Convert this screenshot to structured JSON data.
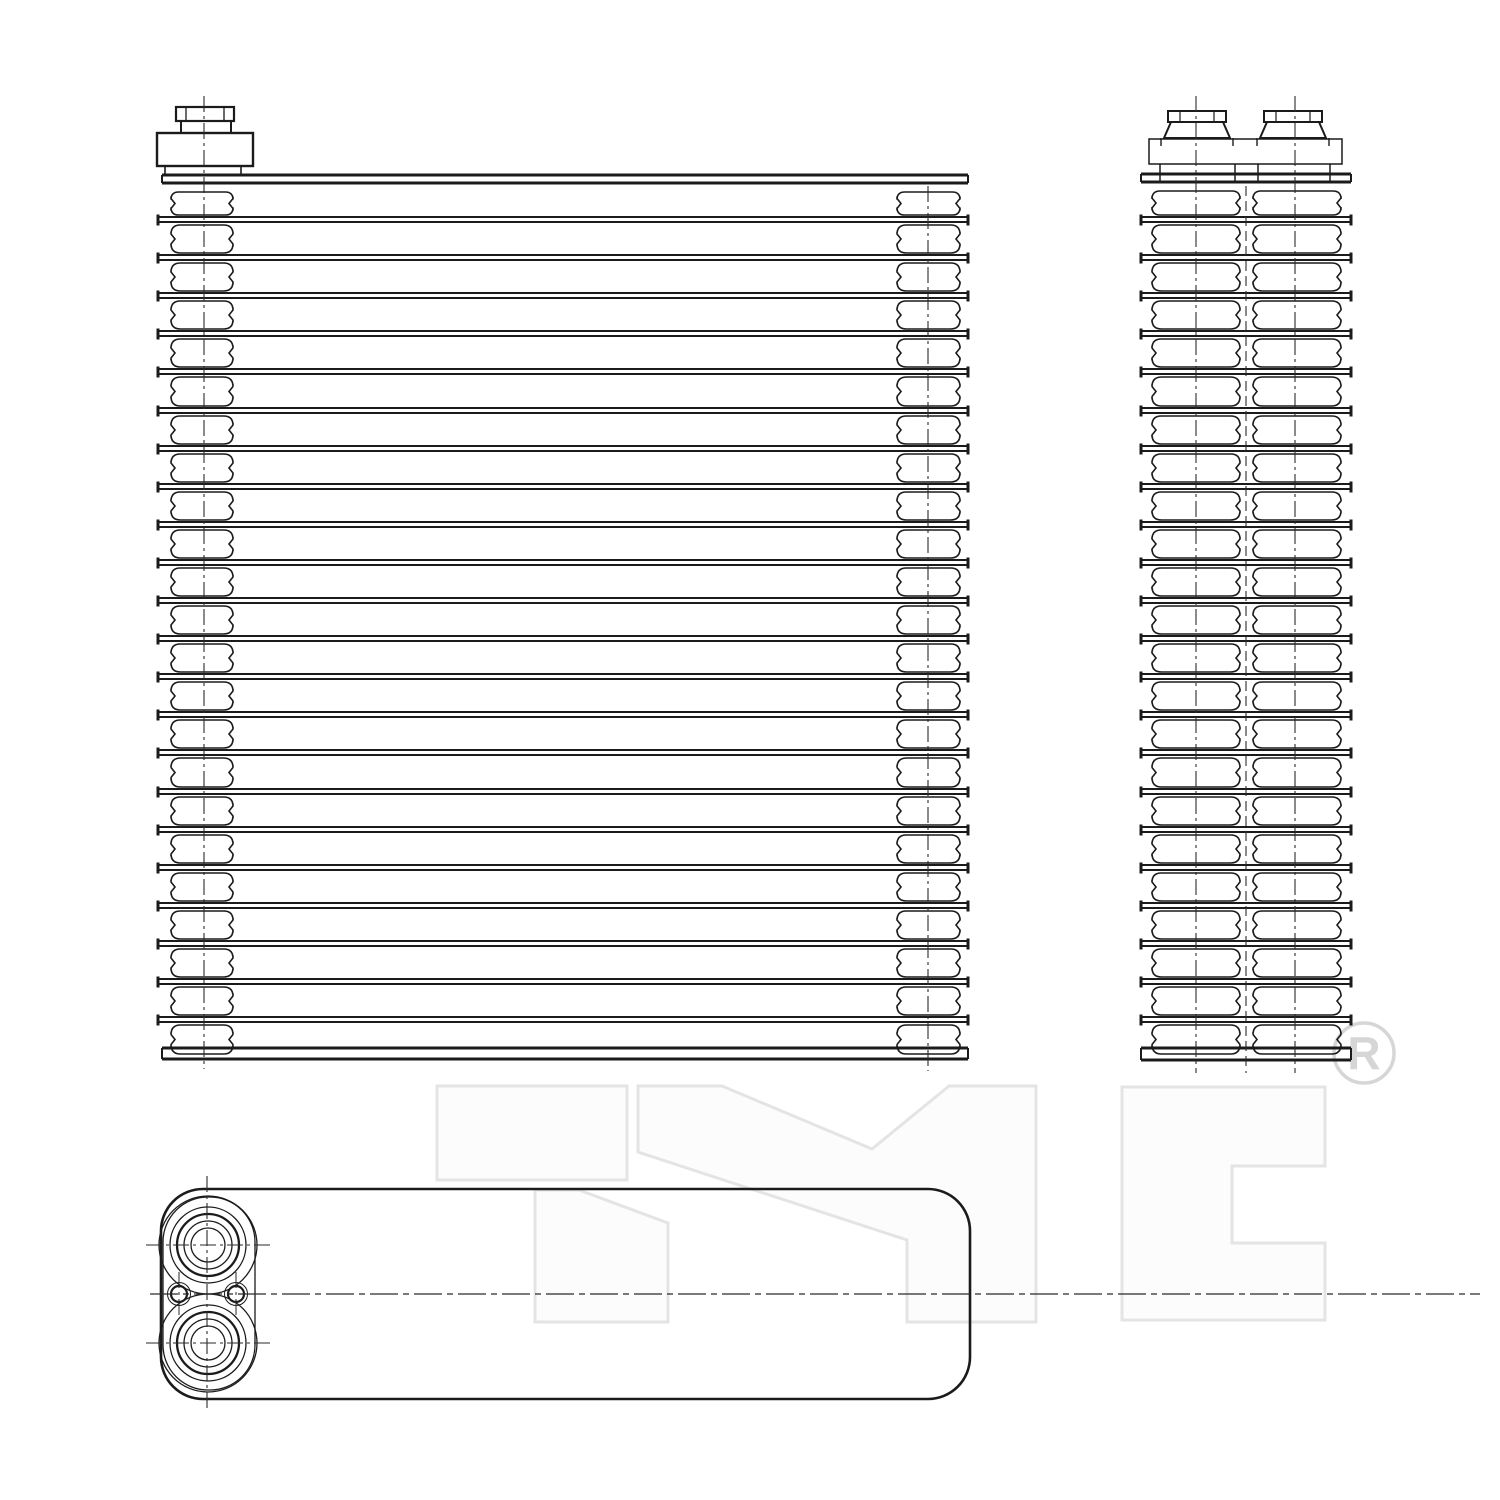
{
  "page": {
    "background": "#ffffff",
    "line_color": "#1b1b1b",
    "thin_line_color": "#2a2a2a",
    "watermark_outline_color": "#e4e4e4",
    "watermark_fill_color": "#fcfcfc",
    "registered_mark_color": "#d6d6d6"
  },
  "watermark": {
    "text": "TYC",
    "registered_symbol": "®",
    "registered_letter": "R",
    "reg_cx": 1364,
    "reg_cy": 1053,
    "reg_r": 30
  },
  "fins": {
    "count": 22,
    "first_y": 217,
    "spacing": 38.1,
    "band_gap": 5
  },
  "front_view": {
    "fin_x1": 158,
    "fin_x2": 968,
    "top_plate": {
      "x1": 162,
      "x2": 968,
      "y1": 175,
      "y2": 183
    },
    "bottom_plate": {
      "x1": 162,
      "x2": 968,
      "y1": 1048,
      "y2": 1059
    },
    "left_column": {
      "x1": 171,
      "x2": 233,
      "centerline_x": 202
    },
    "right_column": {
      "x1": 897,
      "x2": 960,
      "centerline_x": 928
    },
    "fitting": {
      "cap": {
        "x": 176,
        "y": 107,
        "w": 58,
        "h": 14
      },
      "neck": {
        "x": 181,
        "y": 121,
        "w": 50,
        "h": 12
      },
      "body": {
        "x": 157,
        "y": 133,
        "w": 96,
        "h": 33
      },
      "base": {
        "x": 165,
        "y": 166,
        "w": 76,
        "h": 9
      },
      "centerline_x": 204
    }
  },
  "side_view": {
    "fin_x1": 1141,
    "fin_x2": 1351,
    "top_plate": {
      "x1": 1141,
      "x2": 1351,
      "y1": 174,
      "y2": 182
    },
    "bottom_plate": {
      "x1": 1141,
      "x2": 1351,
      "y1": 1048,
      "y2": 1060
    },
    "left_column": {
      "x1": 1152,
      "x2": 1240,
      "centerline_x": 1196
    },
    "right_column": {
      "x1": 1253,
      "x2": 1341,
      "centerline_x": 1295
    },
    "center_gap_x": 1246,
    "header": {
      "x1": 1149,
      "x2": 1342,
      "y1": 139,
      "y2": 164
    },
    "header_ticks_x": [
      1160,
      1235,
      1258,
      1330
    ],
    "stubs": [
      {
        "cx": 1197
      },
      {
        "cx": 1293
      }
    ],
    "stub_shape": {
      "cap_w": 58,
      "cap_y": 111,
      "cap_h": 11,
      "top_w": 52,
      "bot_w": 66,
      "bot_y": 138
    }
  },
  "bottom_view": {
    "body": {
      "x1": 161,
      "y1": 1189,
      "x2": 970,
      "y2": 1399,
      "radius": 42
    },
    "boss": {
      "x1": 163,
      "y1": 1197,
      "x2": 255,
      "y2": 1390,
      "radius": 45
    },
    "ports": [
      {
        "cx": 208,
        "cy": 1245,
        "radii": [
          49,
          38,
          31,
          24,
          17
        ]
      },
      {
        "cx": 208,
        "cy": 1343,
        "radii": [
          49,
          38,
          31,
          24,
          17
        ]
      }
    ],
    "bolt_holes": [
      {
        "cx": 179,
        "cy": 1294,
        "r": 8
      },
      {
        "cx": 236,
        "cy": 1294,
        "r": 8
      }
    ],
    "vertical_centerline": {
      "x": 207,
      "y1": 1176,
      "y2": 1410
    },
    "main_axis": {
      "y": 1294,
      "x1": 150,
      "x2": 1480
    },
    "port_crosshairs": [
      {
        "y": 1245,
        "x1": 146,
        "x2": 270
      },
      {
        "y": 1343,
        "x1": 146,
        "x2": 270
      }
    ],
    "bolt_centerlines": [
      {
        "x": 179,
        "y1": 1272,
        "y2": 1316
      },
      {
        "x": 236,
        "y1": 1272,
        "y2": 1316
      }
    ]
  }
}
